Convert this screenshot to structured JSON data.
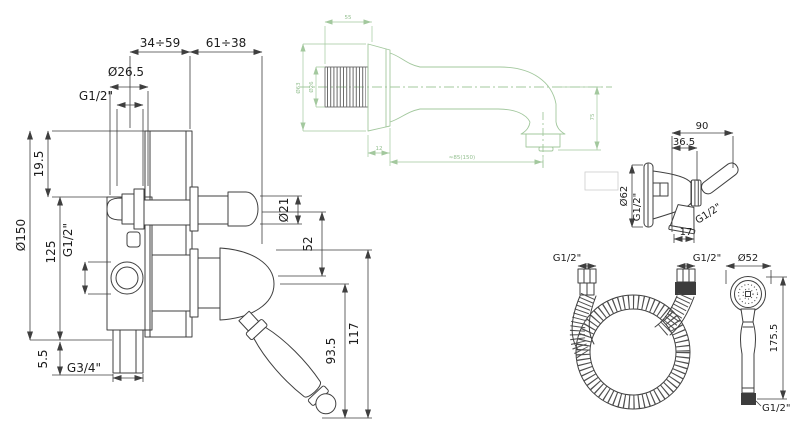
{
  "drawing": {
    "line_color": "#3f3f3f",
    "spout_line_color": "#a3c89e",
    "background": "#ffffff",
    "mixer": {
      "dim_depth_range_left": "34÷59",
      "dim_depth_range_right": "61÷38",
      "dim_knob_cap": "Ø26.5",
      "dim_top_thread": "G1/2\"",
      "dim_top_offset": "19.5",
      "dim_plate": "Ø150",
      "dim_center_height": "125",
      "dim_side_port_thread": "G1/2\"",
      "dim_bottom_offset": "5.5",
      "dim_bottom_thread": "G3/4\"",
      "dim_stem": "Ø21",
      "dim_stem_offset": "52",
      "dim_handle": "93.5",
      "dim_handle_total": "117"
    },
    "spout": {
      "dim_thread_length": "55",
      "dim_flange": "Ø63",
      "dim_thread": "Ø26",
      "dim_flange_depth": "12",
      "dim_projection": "≈85(150)",
      "dim_drop": "75"
    },
    "holder": {
      "dim_width": "90",
      "dim_offset": "36.5",
      "dim_flange": "Ø62",
      "dim_inlet_thread": "G1/2\"",
      "dim_socket_thread": "G1/2\"",
      "dim_socket_offset": "17"
    },
    "hose": {
      "dim_end_left": "G1/2\"",
      "dim_end_right": "G1/2\""
    },
    "handshower": {
      "dim_head": "Ø52",
      "dim_length": "175.5",
      "dim_thread": "G1/2\""
    }
  }
}
